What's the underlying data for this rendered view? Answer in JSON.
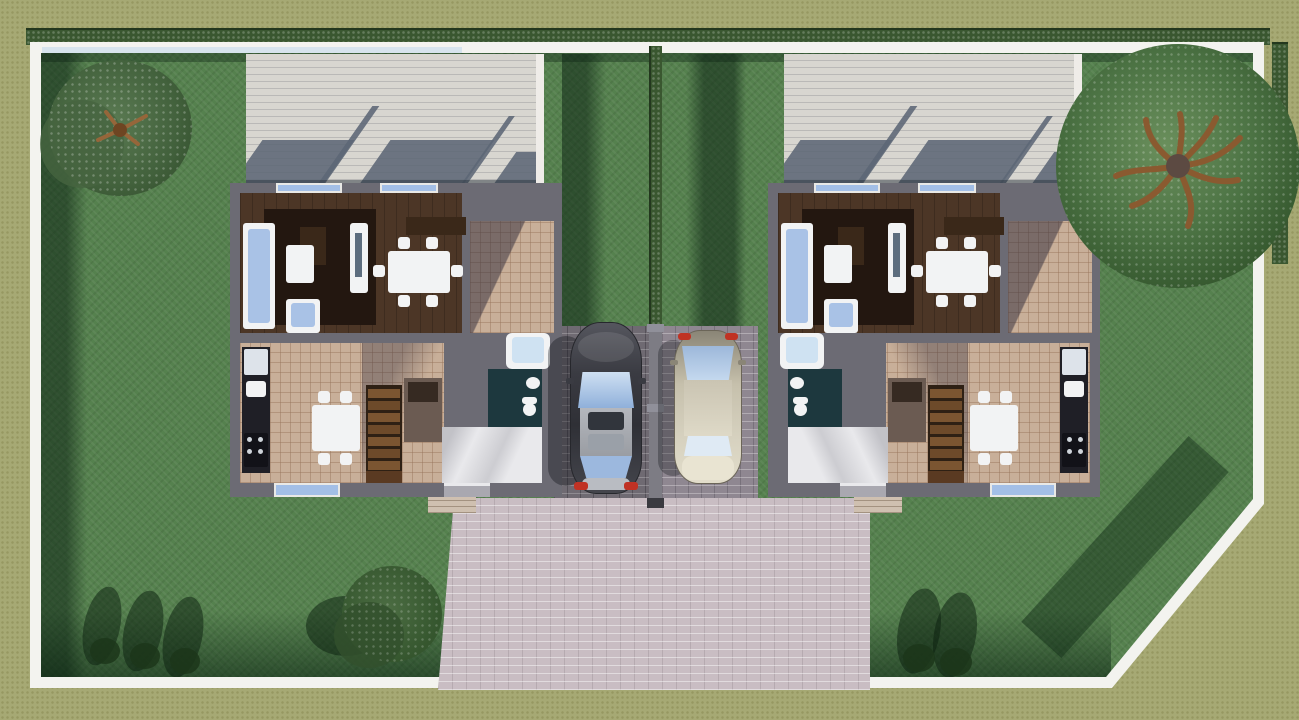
{
  "scene": {
    "type": "3d-site-plan-top-view",
    "description": "Top-down 3D architectural rendering of a duplex lot: two attached single-family houses with furnished ground-floor plans, two cars parked on brick driveways between them, a large paved apron to the street, lawns with trees and hedges, all enclosed by a white boundary wall with a chamfered bottom-right corner.",
    "aria_label": "3D rendered site plan of a duplex with two furnished floor plans, two parked cars, lawns, trees and a white boundary wall"
  },
  "palette": {
    "outer": "#a6a974",
    "border": "#f3f3ef",
    "hedge": "#3a5730",
    "hedgeDark": "#23371e",
    "lawn": "#55814e",
    "patio": "#d8d6d0",
    "patioShadow": "#5c6675",
    "wall": "#6c6b74",
    "wood": "#4c3626",
    "woodDark": "#3a2819",
    "rug": "#231710",
    "tile": "#c8af99",
    "teal": "#1d383e",
    "floorWhite": "#e9e9ec",
    "furnWhite": "#f2f3f4",
    "sofaBlue": "#a9c2e6",
    "glass": "#a3bfe6",
    "stair": "#7b5531",
    "stairDark": "#2e2014",
    "counter": "#1f1f26",
    "brickLight": "#c9bdc3",
    "brickMid": "#8f8791",
    "brickDark": "#6f6a72",
    "carDark": "#3c3d44",
    "carBeige": "#c6c0ac",
    "roofSilver": "#b4b7bd",
    "tailRed": "#c03224",
    "branch": "#8a5a30",
    "canopyLight": "#6a8f5c",
    "canopyDark": "#36592f",
    "closet": "#6b5b52",
    "porch": "#cfc0b0"
  },
  "site": {
    "boundary": "rectangular white wall, chamfered bottom-right corner",
    "hedges": [
      "top boundary hedge",
      "right boundary hedge",
      "center lot-divider hedge"
    ],
    "tree_count": 3,
    "trees": [
      "small tree top-left lawn",
      "large tree top-right lawn",
      "small tree bottom-center lawn"
    ],
    "bush_shadow_groups": [
      "three bushes bottom-left",
      "two bushes bottom-right"
    ],
    "paving": "brick pavers: two parking strips between houses and a large light apron to the street",
    "rear_patios": 2
  },
  "houses": [
    {
      "id": "left-house",
      "rooms": [
        "living room",
        "dining room",
        "terrace",
        "kitchen",
        "stair hall",
        "bathroom",
        "entry hall"
      ],
      "furniture": [
        "sofa",
        "coffee table",
        "armchair",
        "tv console",
        "sideboard",
        "dining table with 6 chairs",
        "kitchen counter with fridge, sink and stove",
        "kitchen table with 4 chairs",
        "staircase",
        "bathtub",
        "washbasin",
        "toilet"
      ]
    },
    {
      "id": "right-house",
      "mirrored_lower_floor": true,
      "rooms": [
        "living room",
        "dining room",
        "terrace",
        "kitchen",
        "stair hall",
        "bathroom",
        "entry hall"
      ],
      "furniture": [
        "sofa",
        "coffee table",
        "armchair",
        "tv console",
        "sideboard",
        "dining table with 6 chairs",
        "kitchen counter with fridge, sink and stove",
        "kitchen table with 4 chairs",
        "staircase",
        "bathtub",
        "washbasin",
        "toilet"
      ]
    }
  ],
  "cars": [
    {
      "id": "car-left",
      "color_name": "dark gray",
      "body_hex": "#3c3d44",
      "facing": "rear toward street"
    },
    {
      "id": "car-right",
      "color_name": "beige",
      "body_hex": "#c6c0ac",
      "facing": "front toward street"
    }
  ]
}
